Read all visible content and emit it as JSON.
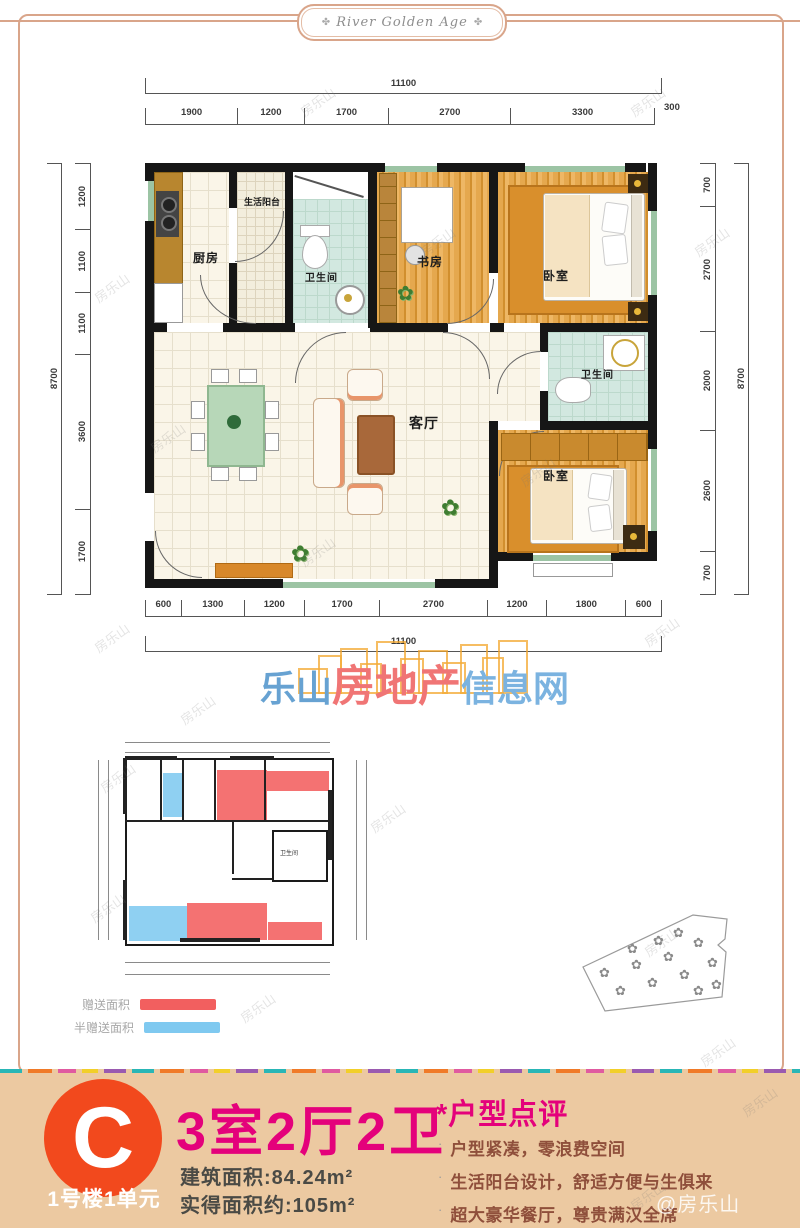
{
  "brand": {
    "name": "River Golden Age",
    "ornament": "✤"
  },
  "floor_plan": {
    "rooms": {
      "kitchen": "厨房",
      "service_balcony": "生活阳台",
      "bathroom_top": "卫生间",
      "study": "书房",
      "bedroom_top": "卧室",
      "bathroom_right": "卫生间",
      "bedroom_bottom": "卧室",
      "living_room": "客厅"
    },
    "dimensions": {
      "top_total": "11100",
      "top_segments": [
        "1900",
        "1200",
        "1700",
        "2700",
        "3300"
      ],
      "top_offset": "300",
      "bottom_total": "11100",
      "bottom_segments": [
        "600",
        "1300",
        "1200",
        "1700",
        "2700",
        "1200",
        "1800",
        "600"
      ],
      "left_total": "8700",
      "left_segments": [
        "1200",
        "1100",
        "1100",
        "3600",
        "1700"
      ],
      "right_total": "8700",
      "right_segments": [
        "700",
        "2700",
        "2000",
        "2600",
        "700"
      ]
    }
  },
  "logo": {
    "text_left": "乐山",
    "text_mid": "房地产",
    "text_right": "信息网",
    "colors": {
      "left": "#5c9ccf",
      "mid": "#ef6b6b",
      "right": "#72aede",
      "skyline": "#f3a62c"
    }
  },
  "small_plan": {
    "bathroom_label": "卫生间"
  },
  "legend": {
    "items": [
      {
        "label": "赠送面积",
        "color": "#f25f5f"
      },
      {
        "label": "半赠送面积",
        "color": "#7fc9f0"
      }
    ]
  },
  "unit": {
    "badge": "C",
    "building": "1号楼1单元",
    "layout": "3室2厅2卫",
    "built_area": "建筑面积:84.24m²",
    "actual_area": "实得面积约:105m²",
    "badge_color": "#f2491d",
    "accent_color": "#e4017b"
  },
  "review": {
    "title": "*户型点评",
    "points": [
      "户型紧凑，零浪费空间",
      "生活阳台设计，舒适方便与生俱来",
      "超大豪华餐厅，尊贵满汉全席"
    ]
  },
  "credit": "@房乐山",
  "watermark": "房乐山"
}
